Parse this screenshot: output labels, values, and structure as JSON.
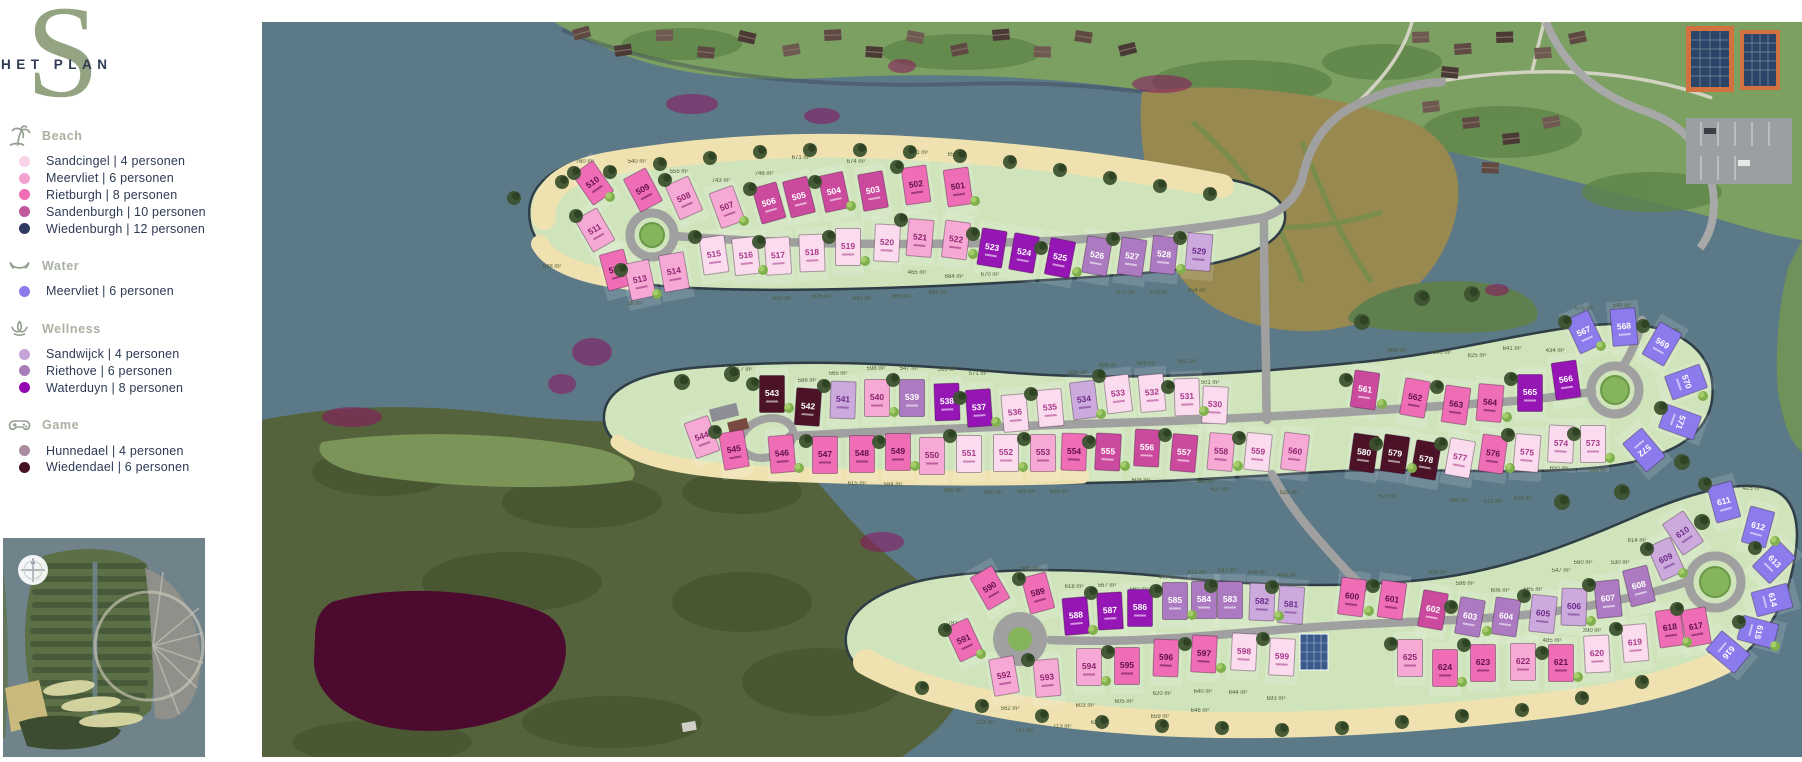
{
  "logo": {
    "letter": "S",
    "title": "HET PLAN"
  },
  "legend": {
    "divider": "|",
    "sections": [
      {
        "title": "Beach",
        "icon": "palm-icon",
        "items": [
          {
            "label": "Sandcingel",
            "persons": "4 personen",
            "color": "#f9d3e8"
          },
          {
            "label": "Meervliet",
            "persons": "6 personen",
            "color": "#f4a2d0"
          },
          {
            "label": "Rietburgh",
            "persons": "8 personen",
            "color": "#ee6db5"
          },
          {
            "label": "Sandenburgh",
            "persons": "10 personen",
            "color": "#c2589e"
          },
          {
            "label": "Wiedenburgh",
            "persons": "12 personen",
            "color": "#2e3a63"
          }
        ]
      },
      {
        "title": "Water",
        "icon": "water-icon",
        "items": [
          {
            "label": "Meervliet",
            "persons": "6 personen",
            "color": "#8b7bec"
          }
        ]
      },
      {
        "title": "Wellness",
        "icon": "lotus-icon",
        "items": [
          {
            "label": "Sandwijck",
            "persons": "4 personen",
            "color": "#c6a3d8"
          },
          {
            "label": "Riethove",
            "persons": "6 personen",
            "color": "#a87eb8"
          },
          {
            "label": "Waterduyn",
            "persons": "8 personen",
            "color": "#9305b0"
          }
        ]
      },
      {
        "title": "Game",
        "icon": "gamepad-icon",
        "items": [
          {
            "label": "Hunnedael",
            "persons": "4 personen",
            "color": "#ab8ba0"
          },
          {
            "label": "Wiedendael",
            "persons": "6 personen",
            "color": "#451224"
          }
        ]
      }
    ]
  },
  "map": {
    "colors": {
      "water": "#5b7987",
      "plan_green": "#cfe4bb",
      "sand": "#efe2b0",
      "road": "#a0a0a0",
      "forest": "#55633c",
      "pond": "#4c0b2e",
      "top_land": "#7ba061",
      "scrub": "#97894f"
    },
    "categories": {
      "b1": {
        "name": "Sandcingel",
        "fill": "#fbdcee",
        "text": "#a83a8c"
      },
      "b2": {
        "name": "Meervliet (Beach)",
        "fill": "#f6a9d4",
        "text": "#8f2570"
      },
      "b3": {
        "name": "Rietburgh",
        "fill": "#ee6db5",
        "text": "#63104a"
      },
      "b4": {
        "name": "Sandenburgh",
        "fill": "#cb4a9d",
        "text": "#ffffff"
      },
      "b5": {
        "name": "Wiedenburgh",
        "fill": "#2e3a63",
        "text": "#ffffff"
      },
      "w6": {
        "name": "Meervliet (Water)",
        "fill": "#8b7bec",
        "text": "#ffffff"
      },
      "s4": {
        "name": "Sandwijck",
        "fill": "#cdaade",
        "text": "#6d2d8a"
      },
      "r6": {
        "name": "Riethove",
        "fill": "#ab7ac0",
        "text": "#ffffff"
      },
      "d8": {
        "name": "Waterduyn",
        "fill": "#9516b4",
        "text": "#ffffff"
      },
      "h4": {
        "name": "Hunnedael",
        "fill": "#b192a8",
        "text": "#ffffff"
      },
      "g6": {
        "name": "Wiedendael",
        "fill": "#4b1228",
        "text": "#ffffff"
      }
    },
    "lots_format": [
      "number",
      "x",
      "y",
      "rotation",
      "category"
    ],
    "lots": [
      [
        "510",
        331,
        161,
        -35,
        "b3"
      ],
      [
        "509",
        381,
        168,
        -28,
        "b3"
      ],
      [
        "508",
        422,
        176,
        -24,
        "b2"
      ],
      [
        "507",
        465,
        185,
        -20,
        "b2"
      ],
      [
        "506",
        507,
        181,
        -16,
        "b4"
      ],
      [
        "505",
        537,
        175,
        -14,
        "b4"
      ],
      [
        "504",
        572,
        170,
        -12,
        "b4"
      ],
      [
        "503",
        611,
        169,
        -10,
        "b4"
      ],
      [
        "502",
        654,
        163,
        -8,
        "b3"
      ],
      [
        "501",
        696,
        165,
        -8,
        "b3"
      ],
      [
        "511",
        333,
        208,
        -30,
        "b2"
      ],
      [
        "512",
        354,
        248,
        -15,
        "b3"
      ],
      [
        "513",
        378,
        258,
        -12,
        "b2"
      ],
      [
        "514",
        412,
        250,
        -10,
        "b2"
      ],
      [
        "515",
        452,
        233,
        -8,
        "b1"
      ],
      [
        "516",
        484,
        234,
        -6,
        "b1"
      ],
      [
        "517",
        516,
        234,
        -4,
        "b1"
      ],
      [
        "518",
        550,
        231,
        -2,
        "b1"
      ],
      [
        "519",
        586,
        225,
        0,
        "b1"
      ],
      [
        "520",
        625,
        221,
        3,
        "b1"
      ],
      [
        "521",
        658,
        216,
        5,
        "b2"
      ],
      [
        "522",
        694,
        218,
        7,
        "b2"
      ],
      [
        "523",
        730,
        226,
        9,
        "d8"
      ],
      [
        "524",
        762,
        231,
        10,
        "d8"
      ],
      [
        "525",
        798,
        236,
        11,
        "d8"
      ],
      [
        "526",
        835,
        234,
        10,
        "r6"
      ],
      [
        "527",
        870,
        235,
        8,
        "r6"
      ],
      [
        "528",
        902,
        233,
        6,
        "r6"
      ],
      [
        "529",
        937,
        230,
        5,
        "s4"
      ],
      [
        "530",
        953,
        383,
        3,
        "b1"
      ],
      [
        "531",
        925,
        375,
        -2,
        "b1"
      ],
      [
        "532",
        890,
        371,
        -5,
        "b1"
      ],
      [
        "533",
        856,
        372,
        -7,
        "b1"
      ],
      [
        "534",
        822,
        378,
        -7,
        "s4"
      ],
      [
        "535",
        788,
        386,
        -5,
        "b1"
      ],
      [
        "536",
        753,
        391,
        -5,
        "b1"
      ],
      [
        "537",
        717,
        386,
        -4,
        "d8"
      ],
      [
        "538",
        685,
        380,
        -2,
        "d8"
      ],
      [
        "539",
        650,
        376,
        0,
        "r6"
      ],
      [
        "540",
        615,
        376,
        0,
        "b2"
      ],
      [
        "541",
        581,
        378,
        2,
        "s4"
      ],
      [
        "542",
        546,
        385,
        4,
        "g6"
      ],
      [
        "543",
        510,
        372,
        0,
        "g6"
      ],
      [
        "544",
        440,
        415,
        -20,
        "b2"
      ],
      [
        "545",
        472,
        428,
        -10,
        "b3"
      ],
      [
        "546",
        520,
        432,
        -5,
        "b3"
      ],
      [
        "547",
        563,
        433,
        0,
        "b3"
      ],
      [
        "548",
        600,
        432,
        0,
        "b3"
      ],
      [
        "549",
        636,
        430,
        0,
        "b3"
      ],
      [
        "550",
        670,
        434,
        0,
        "b2"
      ],
      [
        "551",
        707,
        432,
        0,
        "b1"
      ],
      [
        "552",
        744,
        431,
        0,
        "b1"
      ],
      [
        "553",
        781,
        431,
        0,
        "b2"
      ],
      [
        "554",
        812,
        430,
        2,
        "b3"
      ],
      [
        "555",
        846,
        430,
        3,
        "b4"
      ],
      [
        "556",
        885,
        426,
        3,
        "b4"
      ],
      [
        "557",
        922,
        431,
        5,
        "b4"
      ],
      [
        "558",
        959,
        430,
        5,
        "b2"
      ],
      [
        "559",
        996,
        430,
        6,
        "b1"
      ],
      [
        "560",
        1033,
        430,
        7,
        "b2"
      ],
      [
        "561",
        1103,
        368,
        8,
        "b4"
      ],
      [
        "562",
        1153,
        376,
        10,
        "b3"
      ],
      [
        "563",
        1194,
        383,
        8,
        "b3"
      ],
      [
        "564",
        1228,
        381,
        5,
        "b3"
      ],
      [
        "565",
        1268,
        371,
        0,
        "d8"
      ],
      [
        "566",
        1304,
        358,
        -8,
        "d8"
      ],
      [
        "567",
        1322,
        310,
        -25,
        "w6"
      ],
      [
        "568",
        1362,
        305,
        -5,
        "w6"
      ],
      [
        "569",
        1400,
        322,
        30,
        "w6"
      ],
      [
        "570",
        1424,
        360,
        70,
        "w6"
      ],
      [
        "571",
        1418,
        400,
        110,
        "w6"
      ],
      [
        "572",
        1382,
        428,
        140,
        "w6"
      ],
      [
        "573",
        1331,
        422,
        0,
        "b1"
      ],
      [
        "574",
        1299,
        422,
        3,
        "b1"
      ],
      [
        "575",
        1265,
        431,
        5,
        "b1"
      ],
      [
        "576",
        1231,
        432,
        8,
        "b3"
      ],
      [
        "577",
        1198,
        436,
        10,
        "b1"
      ],
      [
        "578",
        1164,
        438,
        10,
        "g6"
      ],
      [
        "579",
        1133,
        432,
        8,
        "g6"
      ],
      [
        "580",
        1102,
        431,
        8,
        "g6"
      ],
      [
        "581",
        1029,
        583,
        4,
        "s4"
      ],
      [
        "582",
        1000,
        580,
        2,
        "s4"
      ],
      [
        "583",
        968,
        578,
        0,
        "r6"
      ],
      [
        "584",
        942,
        578,
        0,
        "r6"
      ],
      [
        "585",
        913,
        579,
        0,
        "r6"
      ],
      [
        "586",
        878,
        586,
        0,
        "d8"
      ],
      [
        "587",
        848,
        589,
        -3,
        "d8"
      ],
      [
        "588",
        814,
        594,
        -5,
        "d8"
      ],
      [
        "589",
        776,
        571,
        -15,
        "b3"
      ],
      [
        "590",
        728,
        566,
        -30,
        "b3"
      ],
      [
        "591",
        702,
        618,
        -25,
        "b3"
      ],
      [
        "592",
        742,
        654,
        -10,
        "b2"
      ],
      [
        "593",
        785,
        656,
        -5,
        "b2"
      ],
      [
        "594",
        827,
        645,
        0,
        "b2"
      ],
      [
        "595",
        865,
        644,
        0,
        "b3"
      ],
      [
        "596",
        904,
        636,
        2,
        "b3"
      ],
      [
        "597",
        942,
        632,
        3,
        "b3"
      ],
      [
        "598",
        982,
        630,
        3,
        "b1"
      ],
      [
        "599",
        1020,
        635,
        3,
        "b1"
      ],
      [
        "600",
        1090,
        575,
        7,
        "b3"
      ],
      [
        "601",
        1130,
        578,
        8,
        "b3"
      ],
      [
        "602",
        1171,
        588,
        10,
        "b4"
      ],
      [
        "603",
        1208,
        595,
        10,
        "r6"
      ],
      [
        "604",
        1244,
        595,
        8,
        "r6"
      ],
      [
        "605",
        1281,
        592,
        6,
        "s4"
      ],
      [
        "606",
        1312,
        585,
        2,
        "s4"
      ],
      [
        "607",
        1346,
        577,
        -6,
        "r6"
      ],
      [
        "608",
        1377,
        564,
        -14,
        "r6"
      ],
      [
        "609",
        1404,
        537,
        -24,
        "s4"
      ],
      [
        "610",
        1421,
        511,
        -34,
        "s4"
      ],
      [
        "611",
        1462,
        480,
        -15,
        "w6"
      ],
      [
        "612",
        1496,
        505,
        15,
        "w6"
      ],
      [
        "613",
        1512,
        540,
        45,
        "w6"
      ],
      [
        "614",
        1510,
        578,
        75,
        "w6"
      ],
      [
        "615",
        1496,
        610,
        105,
        "w6"
      ],
      [
        "616",
        1466,
        630,
        130,
        "w6"
      ],
      [
        "617",
        1434,
        605,
        -10,
        "b3"
      ],
      [
        "618",
        1408,
        606,
        -8,
        "b3"
      ],
      [
        "619",
        1373,
        621,
        -5,
        "b1"
      ],
      [
        "620",
        1335,
        632,
        -3,
        "b1"
      ],
      [
        "621",
        1299,
        641,
        0,
        "b3"
      ],
      [
        "622",
        1261,
        640,
        0,
        "b2"
      ],
      [
        "623",
        1221,
        641,
        0,
        "b3"
      ],
      [
        "624",
        1183,
        646,
        0,
        "b3"
      ],
      [
        "625",
        1148,
        636,
        0,
        "b2"
      ]
    ],
    "area_labels": [
      [
        "760 m²",
        323,
        141
      ],
      [
        "540 m²",
        375,
        141
      ],
      [
        "555 m²",
        417,
        151
      ],
      [
        "743 m²",
        459,
        160
      ],
      [
        "746 m²",
        502,
        153
      ],
      [
        "671 m²",
        539,
        137
      ],
      [
        "674 m²",
        594,
        141
      ],
      [
        "651 m²",
        657,
        132
      ],
      [
        "653 m²",
        695,
        134
      ],
      [
        "970 m²",
        325,
        197
      ],
      [
        "648 m²",
        290,
        246
      ],
      [
        "58 m²",
        373,
        283
      ],
      [
        "610 m²",
        520,
        278
      ],
      [
        "626 m²",
        560,
        276
      ],
      [
        "641 m²",
        600,
        278
      ],
      [
        "663 m²",
        640,
        276
      ],
      [
        "694 m²",
        676,
        272
      ],
      [
        "465 m²",
        655,
        252
      ],
      [
        "684 m²",
        692,
        256
      ],
      [
        "670 m²",
        728,
        254
      ],
      [
        "572 m²",
        864,
        272
      ],
      [
        "573 m²",
        897,
        272
      ],
      [
        "454 m²",
        935,
        270
      ],
      [
        "717 m²",
        481,
        349
      ],
      [
        "588 m²",
        545,
        360
      ],
      [
        "565 m²",
        576,
        353
      ],
      [
        "598 m²",
        614,
        348
      ],
      [
        "547 m²",
        647,
        348
      ],
      [
        "566 m²",
        685,
        349
      ],
      [
        "571 m²",
        716,
        353
      ],
      [
        "535 m²",
        816,
        352
      ],
      [
        "498 m²",
        846,
        345
      ],
      [
        "509 m²",
        884,
        343
      ],
      [
        "502 m²",
        925,
        341
      ],
      [
        "501 m²",
        948,
        362
      ],
      [
        "806 m²",
        1135,
        330
      ],
      [
        "600 m²",
        1180,
        332
      ],
      [
        "625 m²",
        1215,
        335
      ],
      [
        "641 m²",
        1250,
        328
      ],
      [
        "434 m²",
        1293,
        330
      ],
      [
        "575 m²",
        1322,
        288
      ],
      [
        "549 m²",
        1360,
        285
      ],
      [
        "408 m²",
        1408,
        310
      ],
      [
        "615 m²",
        595,
        463
      ],
      [
        "584 m²",
        631,
        464
      ],
      [
        "596 m²",
        691,
        470
      ],
      [
        "565 m²",
        731,
        472
      ],
      [
        "588 m²",
        764,
        471
      ],
      [
        "606 m²",
        797,
        471
      ],
      [
        "608 m²",
        879,
        460
      ],
      [
        "688 m²",
        943,
        461
      ],
      [
        "627 m²",
        958,
        469
      ],
      [
        "528 m²",
        1027,
        472
      ],
      [
        "575 m²",
        1126,
        476
      ],
      [
        "560 m²",
        1197,
        480
      ],
      [
        "572 m²",
        1231,
        481
      ],
      [
        "628 m²",
        1261,
        478
      ],
      [
        "650 m²",
        1297,
        448
      ],
      [
        "596 m²",
        1336,
        450
      ],
      [
        "614 m²",
        1375,
        520
      ],
      [
        "585 m²",
        768,
        548
      ],
      [
        "618 m²",
        812,
        566
      ],
      [
        "567 m²",
        845,
        565
      ],
      [
        "560 m²",
        877,
        569
      ],
      [
        "477 m²",
        906,
        557
      ],
      [
        "471 m²",
        935,
        552
      ],
      [
        "537 m²",
        965,
        550
      ],
      [
        "506 m²",
        995,
        552
      ],
      [
        "443 m²",
        1025,
        555
      ],
      [
        "782 m²",
        695,
        603
      ],
      [
        "562 m²",
        748,
        688
      ],
      [
        "603 m²",
        823,
        685
      ],
      [
        "605 m²",
        862,
        681
      ],
      [
        "620 m²",
        900,
        673
      ],
      [
        "640 m²",
        941,
        671
      ],
      [
        "644 m²",
        976,
        672
      ],
      [
        "693 m²",
        1014,
        678
      ],
      [
        "630 m²",
        1176,
        552
      ],
      [
        "586 m²",
        1203,
        563
      ],
      [
        "606 m²",
        1238,
        570
      ],
      [
        "565 m²",
        1271,
        569
      ],
      [
        "547 m²",
        1299,
        550
      ],
      [
        "560 m²",
        1321,
        542
      ],
      [
        "530 m²",
        1358,
        542
      ],
      [
        "723 m²",
        723,
        702
      ],
      [
        "727 m²",
        762,
        710
      ],
      [
        "713 m²",
        800,
        706
      ],
      [
        "633 m²",
        838,
        702
      ],
      [
        "659 m²",
        898,
        696
      ],
      [
        "646 m²",
        938,
        690
      ],
      [
        "485 m²",
        1290,
        620
      ],
      [
        "390 m²",
        1330,
        610
      ],
      [
        "429 m²",
        1455,
        632
      ],
      [
        "423 m²",
        1520,
        568
      ],
      [
        "425 m²",
        1490,
        468
      ]
    ]
  }
}
